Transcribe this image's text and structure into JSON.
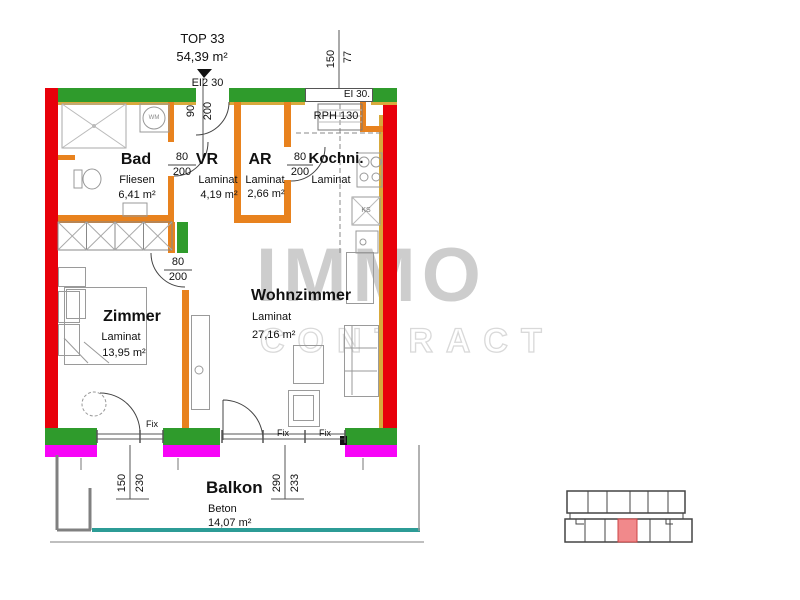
{
  "title": {
    "top": "TOP 33",
    "area": "54,39 m²",
    "entrance_door": "EI2 30"
  },
  "rooms": {
    "bad": {
      "name": "Bad",
      "floor": "Fliesen",
      "area": "6,41 m²"
    },
    "vr": {
      "name": "VR",
      "floor": "Laminat",
      "area": "4,19 m²"
    },
    "ar": {
      "name": "AR",
      "floor": "Laminat",
      "area": "2,66 m²"
    },
    "kueche": {
      "name": "Kochni.",
      "floor": "Laminat"
    },
    "zimmer": {
      "name": "Zimmer",
      "floor": "Laminat",
      "area": "13,95 m²"
    },
    "wohnzimmer": {
      "name": "Wohnzimmer",
      "floor": "Laminat",
      "area": "27,16 m²"
    },
    "balkon": {
      "name": "Balkon",
      "floor": "Beton",
      "area": "14,07 m²"
    }
  },
  "dimensions": {
    "entrance": {
      "w": "90",
      "h": "200"
    },
    "top_window": {
      "w": "150",
      "h": "77"
    },
    "bad_door": {
      "w": "80",
      "h": "200"
    },
    "ar_door": {
      "w": "80",
      "h": "200"
    },
    "zimmer_door": {
      "w": "80",
      "h": "200"
    },
    "zimmer_window": {
      "w": "150",
      "h": "230"
    },
    "wohn_window": {
      "w": "290",
      "h": "233"
    }
  },
  "annotations": {
    "top_window_label": "EI 30.",
    "range_hood": "RPH 130",
    "fridge": "KS",
    "washer": "WM",
    "fix": [
      "Fix",
      "Fix",
      "Fix"
    ]
  },
  "watermark": {
    "line1": "IMMO",
    "line2": "CONTRACT"
  },
  "colors": {
    "exterior_wall": "#e8000a",
    "loadbearing_wall": "#2f9b2c",
    "interior_wall": "#e8821e",
    "window_sill": "#f704f7",
    "insulation": "#d8a93c",
    "balcony_edge": "#2c9c96",
    "overview_highlight": "#f1898b"
  }
}
